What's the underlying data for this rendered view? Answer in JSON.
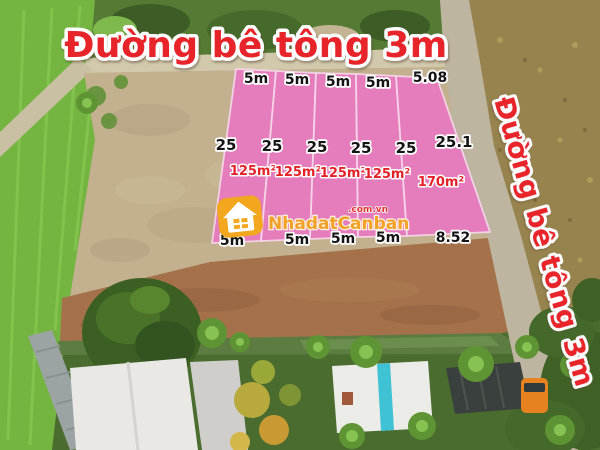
{
  "road_labels": {
    "top": "Đường bê tông 3m",
    "right": "Đường bê tông 3m"
  },
  "plots": {
    "top_dims": [
      "5m",
      "5m",
      "5m",
      "5m",
      "5.08"
    ],
    "side_dims": [
      "25",
      "25",
      "25",
      "25",
      "25",
      "25.1"
    ],
    "areas": [
      "125m²",
      "125m²",
      "125m²",
      "125m²",
      "170m²"
    ],
    "bottom_dims": [
      "5m",
      "5m",
      "5m",
      "5m",
      "8.52"
    ]
  },
  "watermark": {
    "brand": "NhadatCanban",
    "suffix": ".com.vn",
    "icon": "house-icon"
  },
  "colors": {
    "plot_pink": "#e878c0",
    "plot_line": "#f6d4ea",
    "title_red": "#e8242b",
    "label_red": "#e32128",
    "brand_orange": "#f2a51e",
    "suffix_red": "#e03030"
  }
}
